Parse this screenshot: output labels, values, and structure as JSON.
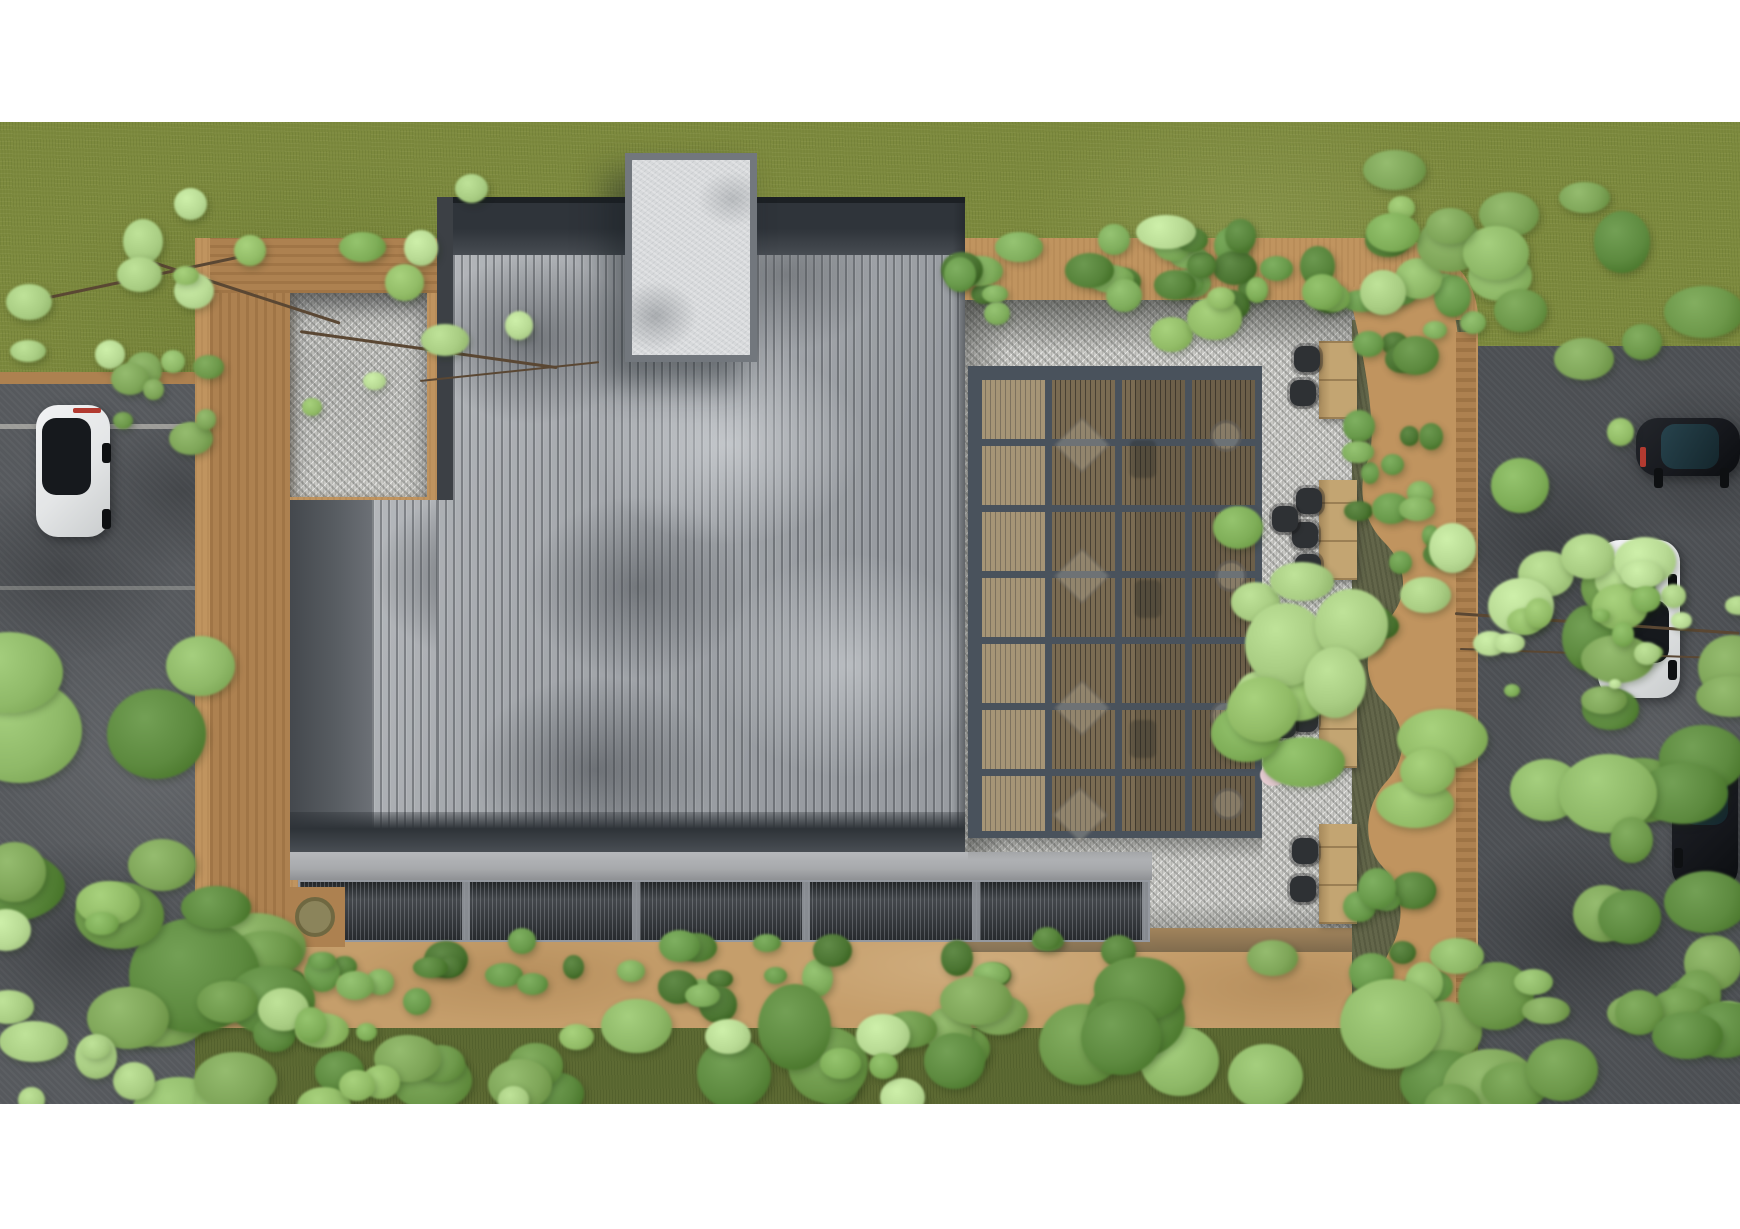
{
  "meta": {
    "description": "Top-down aerial architectural rendering: building with gray standing-seam roof and white rooftop core, steel pergola over wood deck, gravel courtyard with four wooden tables and dark chairs, curvy planter wall with shrubs, perimeter tan walls, hedges, surrounding grass, two asphalt roads with four parked cars and overhanging trees"
  },
  "palette": {
    "white": "#ffffff",
    "grass": "#7d8a3e",
    "grass-bottom": "#5d6a33",
    "asphalt": "#56595d",
    "asphalt-right": "#4c4f53",
    "tan-wall": "#c0945f",
    "tan-wood": "#ad8150",
    "tan-path": "#c59e6b",
    "gravel": "#c8c8c4",
    "roof-light": "#b4b7bb",
    "roof-mid": "#989ca1",
    "parapet": "#2f343a",
    "facade": "#585d62",
    "eave": "#2e3338",
    "fascia": "#a7a9ac",
    "louver": "#34383d",
    "core": "#d7d9db",
    "core-frame": "#72777d",
    "beam": "#49525c",
    "pergola-wood": "#8b7a5d",
    "bed": "#63664a",
    "table": "#c3a572",
    "chair": "#2e3134",
    "car-white": "#e3e5e6",
    "car-glass": "#16191d",
    "car-dark": "#17191e",
    "car-teal": "#27434d",
    "tail-red": "#b23a30",
    "person": "#e6cdd2",
    "marker-red": "#a64a32",
    "branch": "#5a4733"
  },
  "kinds": {
    "bright": [
      "#a9cd83",
      "#92bc67",
      "#7fae58",
      "#b8da94"
    ],
    "mid": [
      "#7fa659",
      "#6d984a",
      "#8fb968",
      "#5d8a3f"
    ],
    "dark": [
      "#4e7a35",
      "#446b2e",
      "#61884a",
      "#3a591f"
    ],
    "hedge": [
      "#56833a",
      "#699a4b",
      "#80ae5d",
      "#4b7532"
    ]
  },
  "scene": {
    "tables": [
      {
        "name": "patio-table-1",
        "x": 1319,
        "y": 219,
        "w": 38,
        "h": 78
      },
      {
        "name": "patio-table-2",
        "x": 1319,
        "y": 358,
        "w": 38,
        "h": 100
      },
      {
        "name": "patio-table-3",
        "x": 1319,
        "y": 532,
        "w": 38,
        "h": 114
      },
      {
        "name": "patio-table-4",
        "x": 1319,
        "y": 702,
        "w": 38,
        "h": 100
      }
    ],
    "chairs": [
      [
        1294,
        224
      ],
      [
        1290,
        258
      ],
      [
        1296,
        366
      ],
      [
        1292,
        400
      ],
      [
        1295,
        432
      ],
      [
        1272,
        384
      ],
      [
        1295,
        546
      ],
      [
        1292,
        584
      ],
      [
        1295,
        620
      ],
      [
        1270,
        590
      ],
      [
        1292,
        716
      ],
      [
        1290,
        754
      ]
    ],
    "pergola_hints": {
      "diamonds": [
        [
          1062,
          303
        ],
        [
          1062,
          434
        ],
        [
          1062,
          566
        ],
        [
          1060,
          673
        ]
      ],
      "circles": [
        [
          1210,
          298
        ],
        [
          1215,
          438
        ],
        [
          1210,
          578
        ],
        [
          1212,
          666
        ]
      ],
      "pairs": [
        [
          1130,
          318
        ],
        [
          1135,
          458
        ],
        [
          1130,
          598
        ]
      ]
    },
    "cars": [
      {
        "name": "white-car-left",
        "kind": "white",
        "x": 36,
        "y": 283,
        "w": 74,
        "h": 132,
        "glass": {
          "l": 8,
          "t": 10,
          "w": 66,
          "r": 58
        },
        "tail": "top",
        "wheels": [
          [
            66,
            38
          ],
          [
            66,
            104
          ]
        ]
      },
      {
        "name": "dark-car-top-right",
        "kind": "dark",
        "x": 1636,
        "y": 296,
        "w": 104,
        "h": 58,
        "glass": {
          "l": 24,
          "t": 10,
          "w": 56,
          "r": 78
        },
        "teal": true,
        "tail": "left",
        "wheels": [
          [
            18,
            50
          ],
          [
            84,
            50
          ]
        ]
      },
      {
        "name": "white-car-right",
        "kind": "white",
        "x": 1598,
        "y": 418,
        "w": 82,
        "h": 158,
        "glass": {
          "l": 13,
          "t": 38,
          "w": 74,
          "r": 40
        },
        "wheels": [
          [
            70,
            34
          ],
          [
            70,
            120
          ]
        ]
      },
      {
        "name": "dark-car-bottom-right",
        "kind": "dark",
        "x": 1672,
        "y": 620,
        "w": 66,
        "h": 148,
        "glass": {
          "l": 15,
          "t": 20,
          "w": 70,
          "r": 36
        },
        "teal": true,
        "wheels": [
          [
            2,
            40
          ],
          [
            2,
            106
          ]
        ]
      }
    ],
    "foliage": [
      {
        "name": "hedge-top",
        "x": 960,
        "y": 114,
        "w": 436,
        "h": 78,
        "n": 30,
        "kind": "hedge",
        "min": 10,
        "max": 20,
        "z": 40,
        "seed": 11
      },
      {
        "name": "hedge-bottom",
        "x": 222,
        "y": 814,
        "w": 930,
        "h": 76,
        "n": 34,
        "kind": "hedge",
        "min": 10,
        "max": 20,
        "z": 40,
        "seed": 12
      },
      {
        "name": "hedge-corner-right",
        "x": 1345,
        "y": 160,
        "w": 140,
        "h": 110,
        "n": 12,
        "kind": "hedge",
        "min": 10,
        "max": 20,
        "z": 40,
        "seed": 13
      },
      {
        "name": "hedge-right-upper",
        "x": 1358,
        "y": 286,
        "w": 80,
        "h": 110,
        "n": 8,
        "kind": "hedge",
        "min": 8,
        "max": 16,
        "z": 40,
        "seed": 14
      },
      {
        "name": "hedge-right-mid",
        "x": 1362,
        "y": 376,
        "w": 95,
        "h": 160,
        "n": 10,
        "kind": "hedge",
        "min": 9,
        "max": 18,
        "z": 40,
        "seed": 15
      },
      {
        "name": "hedge-right-lower",
        "x": 1352,
        "y": 738,
        "w": 120,
        "h": 160,
        "n": 11,
        "kind": "hedge",
        "min": 10,
        "max": 20,
        "z": 40,
        "seed": 16
      },
      {
        "name": "tree-sparse-top-left",
        "x": 0,
        "y": 58,
        "w": 560,
        "h": 250,
        "n": 18,
        "kind": "bright",
        "min": 8,
        "max": 22,
        "z": 60,
        "seed": 21
      },
      {
        "name": "shrub-left-roadside",
        "x": 118,
        "y": 220,
        "w": 110,
        "h": 125,
        "n": 9,
        "kind": "mid",
        "min": 10,
        "max": 20,
        "z": 60,
        "seed": 22
      },
      {
        "name": "tree-left-bottom",
        "x": -50,
        "y": 478,
        "w": 320,
        "h": 420,
        "n": 15,
        "kind": "mid",
        "min": 26,
        "max": 55,
        "z": 60,
        "seed": 23
      },
      {
        "name": "trees-bottom-center",
        "x": 150,
        "y": 853,
        "w": 880,
        "h": 135,
        "n": 24,
        "kind": "mid",
        "min": 18,
        "max": 40,
        "z": 60,
        "seed": 24
      },
      {
        "name": "trees-bottom-center-light",
        "x": 260,
        "y": 878,
        "w": 700,
        "h": 110,
        "n": 14,
        "kind": "bright",
        "min": 10,
        "max": 26,
        "z": 61,
        "seed": 25
      },
      {
        "name": "trees-bottom-right",
        "x": 1040,
        "y": 828,
        "w": 540,
        "h": 160,
        "n": 16,
        "kind": "mid",
        "min": 20,
        "max": 42,
        "z": 60,
        "seed": 26
      },
      {
        "name": "trees-top-right",
        "x": 1385,
        "y": 43,
        "w": 360,
        "h": 240,
        "n": 14,
        "kind": "mid",
        "min": 16,
        "max": 36,
        "z": 60,
        "seed": 27
      },
      {
        "name": "tree-top-center-right",
        "x": 1150,
        "y": 58,
        "w": 260,
        "h": 160,
        "n": 10,
        "kind": "bright",
        "min": 10,
        "max": 24,
        "z": 60,
        "seed": 28
      },
      {
        "name": "tree-over-planter",
        "x": 1215,
        "y": 383,
        "w": 270,
        "h": 310,
        "n": 16,
        "kind": "bright",
        "min": 18,
        "max": 40,
        "z": 60,
        "seed": 29
      },
      {
        "name": "tree-over-white-car",
        "x": 1545,
        "y": 438,
        "w": 215,
        "h": 250,
        "n": 12,
        "kind": "mid",
        "min": 18,
        "max": 38,
        "z": 60,
        "seed": 30
      },
      {
        "name": "tree-right-mid",
        "x": 1470,
        "y": 308,
        "w": 180,
        "h": 200,
        "n": 10,
        "kind": "bright",
        "min": 14,
        "max": 28,
        "z": 60,
        "seed": 31
      },
      {
        "name": "vine-row-right",
        "x": 1455,
        "y": 468,
        "w": 285,
        "h": 120,
        "n": 14,
        "kind": "bright",
        "min": 6,
        "max": 14,
        "z": 60,
        "seed": 32
      },
      {
        "name": "tree-right-bottom",
        "x": 1580,
        "y": 698,
        "w": 180,
        "h": 230,
        "n": 10,
        "kind": "mid",
        "min": 16,
        "max": 34,
        "z": 60,
        "seed": 33
      },
      {
        "name": "trees-far-bottom-right",
        "x": 1500,
        "y": 858,
        "w": 240,
        "h": 130,
        "n": 8,
        "kind": "mid",
        "min": 14,
        "max": 30,
        "z": 60,
        "seed": 34
      },
      {
        "name": "shrubs-bottom-left-road",
        "x": 0,
        "y": 778,
        "w": 180,
        "h": 210,
        "n": 10,
        "kind": "bright",
        "min": 12,
        "max": 26,
        "z": 60,
        "seed": 35
      }
    ],
    "branches": [
      {
        "x": 30,
        "y": 178,
        "len": 240,
        "ang": -12,
        "w": 3
      },
      {
        "x": 150,
        "y": 138,
        "len": 200,
        "ang": 18,
        "w": 3
      },
      {
        "x": 300,
        "y": 208,
        "len": 260,
        "ang": 8,
        "w": 3
      },
      {
        "x": 420,
        "y": 258,
        "len": 180,
        "ang": -6,
        "w": 2
      },
      {
        "x": 1455,
        "y": 490,
        "len": 285,
        "ang": 4,
        "w": 3
      },
      {
        "x": 1460,
        "y": 526,
        "len": 280,
        "ang": 2,
        "w": 2
      }
    ]
  }
}
